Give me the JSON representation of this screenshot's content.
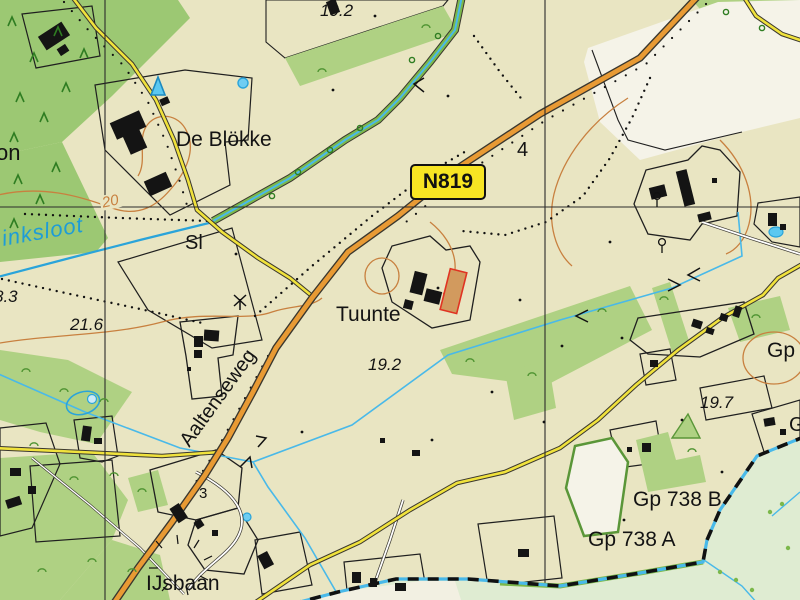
{
  "title": "Topographic map detail - Tuunte / De Blokke area",
  "colors": {
    "bg-cream": "#e9e5c2",
    "field-white": "#f5f3e8",
    "field-green": "#afd183",
    "forest-green": "#9cc873",
    "bank-green": "#7cb84b",
    "pale-green": "#dfecd2",
    "pale-white": "#f2f0e2",
    "water-blue": "#2aa4da",
    "water-light": "#49b9e9",
    "water-fill": "#8fd4f0",
    "contour-orange": "#c8803f",
    "road-orange": "#e89a34",
    "road-yellow": "#f0e23c",
    "road-casing": "#3a372e",
    "building-black": "#141414",
    "sign-yellow": "#f7e523",
    "label-black": "#131313",
    "water-text": "#1e9cd7",
    "red-outline": "#e03322",
    "tan-fill": "#d29a5e",
    "grid-black": "#2b2b2b",
    "tree-green": "#2f7d22",
    "grass-green": "#4f9432"
  },
  "labels": {
    "spot_height_top": "19.2",
    "place_de_blokke": "De Blökke",
    "road_sign_n819": "N819",
    "grid_number": "4",
    "place_partial_on": "on",
    "water_inksloot": "inksloot",
    "abbrev_sl": "Sl",
    "spot_height_83": "8.3",
    "contour_20": "20",
    "spot_height_216": "21.6",
    "place_tuunte": "Tuunte",
    "spot_height_192": "19.2",
    "road_aaltenseweg": "Aaltenseweg",
    "spot_height_197": "19.7",
    "marker_gp": "Gp",
    "marker_g_partial": "G",
    "marker_gp_738b": "Gp 738 B",
    "marker_gp_738a": "Gp 738 A",
    "place_ijsbaan": "IJsbaan",
    "house_number_3": "3"
  }
}
